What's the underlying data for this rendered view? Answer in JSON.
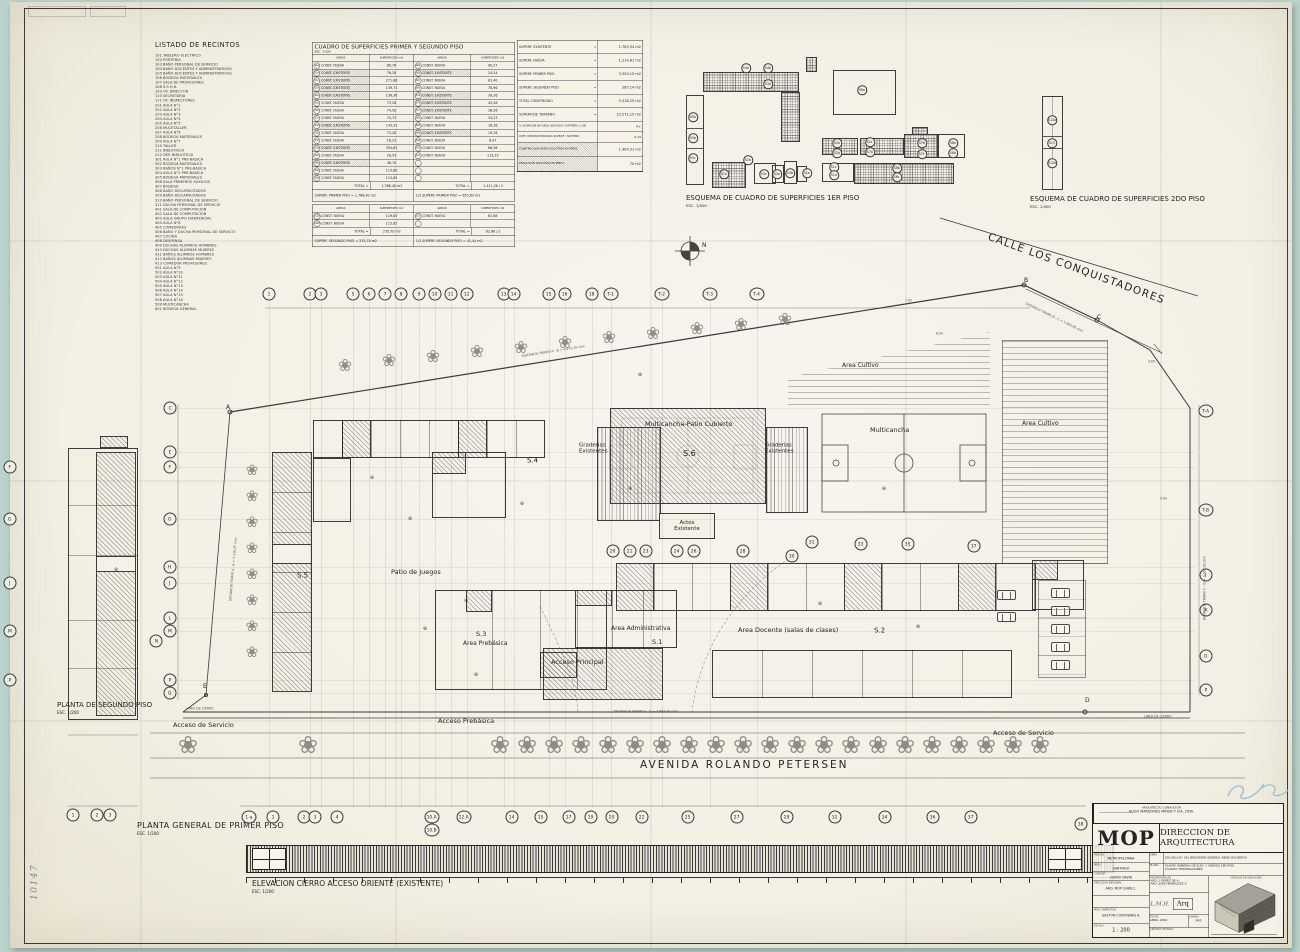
{
  "sheet": {
    "listado_title": "LISTADO DE RECINTOS",
    "planta_general": "PLANTA GENERAL DE PRIMER PISO",
    "planta_general_esc": "ESC. 1/200",
    "planta_segundo": "PLANTA DE SEGUNDO PISO",
    "planta_segundo_esc": "ESC. 1/200",
    "elevacion": "ELEVACION CIERRO ACCESO ORIENTE (EXISTENTE)",
    "elevacion_esc": "ESC. 1/200",
    "esquema1": "ESQUEMA DE CUADRO DE SUPERFICIES 1ER PISO",
    "esquema1_esc": "ESC. 1/500",
    "esquema2": "ESQUEMA DE CUADRO DE SUPERFICIES 2DO PISO",
    "esquema2_esc": "ESC. 1/500",
    "avenida": "AVENIDA ROLANDO PETERSEN",
    "calle": "CALLE LOS CONQUISTADORES",
    "north": "N"
  },
  "annotations": {
    "handwritten_corner": "10147",
    "signature": "L.M.H."
  },
  "listado_items": [
    "101 TABLERO ELECTRICO",
    "102 PORTERIA",
    "103 BAÑO PERSONAL DE SERVICIO",
    "104 BAÑO DOCENTES Y ADMINISTRATIVOS",
    "105 BAÑO DOCENTES Y ADMINISTRATIVOS",
    "106 BODEGA MATERIALES",
    "107 SALA DE PROFESORES",
    "108 S.S.H.H.",
    "109 OF. DIRECTOR",
    "110 SECRETARIA",
    "111 OF. INSPECTORES",
    "201 AULA N°1",
    "202 AULA N°2",
    "203 AULA N°3",
    "204 AULA N°4",
    "205 AULA N°5",
    "206 MULTITALLER",
    "207 AULA N°6",
    "208 BODEGA MATERIALES",
    "209 AULA N°7",
    "210 TALLER",
    "211 BIBLIOTECA",
    "212 DEP. BIBLIOTECA",
    "301 AULA N°1 PRE-BASICA",
    "302 BODEGA MATERIALES",
    "303 BAÑOS N°1 PRE-BASICA",
    "304 AULA N°2 PRE-BASICA",
    "305 BODEGA MATERIALES",
    "306 SALA PRIMEROS AUXILIOS",
    "307 BODEGA",
    "308 BAÑO DISCAPACITADOS",
    "309 BAÑO DISCAPACITADOS",
    "310 BAÑO PERSONAL DE SERVICIO",
    "311 DUCHA PERSONAL DE SERVICIO",
    "401 SALA DE COMPUTACION",
    "402 SALA DE COMPUTACION",
    "403 AULA GRUPO DIFERENCIAL",
    "404 AULA N°8",
    "405 COMEDORES",
    "406 BAÑO Y DUCHA PERSONAL DE SERVICIO",
    "407 COCINA",
    "408 DESPENSA",
    "409 DUCHAS ALUMNOS HOMBRES",
    "410 DUCHAS ALUMNAS MUJERES",
    "411 BAÑOS ALUMNOS HOMBRES",
    "412 BAÑOS ALUMNAS MUJERES",
    "413 COMEDOR PROFESORES",
    "501 AULA N°9",
    "502 AULA N°10",
    "503 AULA N°11",
    "504 AULA N°12",
    "505 AULA N°13",
    "506 AULA N°14",
    "507 AULA N°15",
    "508 AULA N°16",
    "509 MULTICANCHA",
    "601 BODEGA GENERAL"
  ],
  "cuadro": {
    "title": "CUADRO DE SUPERFICIES PRIMER Y SEGUNDO PISO",
    "esc": "ESC. 1/100",
    "headers": [
      "AREAS",
      "SUPERFICIES m2",
      "AREAS",
      "SUPERFICIES m2"
    ],
    "rows1": [
      [
        [
          "S1a",
          "CONST. NUEVA",
          "80,78",
          0
        ],
        [
          "S6a",
          "CONST. NUEVA",
          "90,27",
          0
        ]
      ],
      [
        [
          "S1b",
          "CONST. EXISTENTE",
          "76,28",
          1
        ],
        [
          "S6b",
          "CONST. EXISTENTE",
          "24,54",
          1
        ]
      ],
      [
        [
          "S1c",
          "CONST. EXISTENTE",
          "271,66",
          1
        ],
        [
          "S6c",
          "CONST. NUEVA",
          "61,40",
          0
        ]
      ],
      [
        [
          "S1d",
          "CONST. EXISTENTE",
          "139,71",
          1
        ],
        [
          "S6d",
          "CONST. NUEVA",
          "78,96",
          0
        ]
      ],
      [
        [
          "S1e",
          "CONST. EXISTENTE",
          "136,36",
          1
        ],
        [
          "S7a",
          "CONST. EXISTENTE",
          "39,26",
          1
        ]
      ],
      [
        [
          "S2a",
          "CONST. NUEVA",
          "73,28",
          0
        ],
        [
          "S7b",
          "CONST. EXISTENTE",
          "45,26",
          1
        ]
      ],
      [
        [
          "S2b",
          "CONST. NUEVA",
          "74,50",
          0
        ],
        [
          "S7c",
          "CONST. EXISTENTE",
          "36,26",
          1
        ]
      ],
      [
        [
          "S2c",
          "CONST. NUEVA",
          "74,73",
          0
        ],
        [
          "S8a",
          "CONST. NUEVA",
          "34,23",
          0
        ]
      ],
      [
        [
          "S3a",
          "CONST. EXISTENTE",
          "143,31",
          1
        ],
        [
          "S8b",
          "CONST. NUEVA",
          "18,36",
          0
        ]
      ],
      [
        [
          "S3b",
          "CONST. NUEVA",
          "73,20",
          0
        ],
        [
          "S9a",
          "CONST. EXISTENTE",
          "19,26",
          1
        ]
      ],
      [
        [
          "S3c",
          "CONST. NUEVA",
          "16,23",
          0
        ],
        [
          "S9b",
          "CONST. NUEVA",
          "8,97",
          0
        ]
      ],
      [
        [
          "S3d",
          "CONST. EXISTENTE",
          "394,61",
          1
        ],
        [
          "S10",
          "CONST. NUEVA",
          "86,56",
          0
        ]
      ],
      [
        [
          "S4a",
          "CONST. NUEVA",
          "28,54",
          0
        ],
        [
          "S11",
          "CONST. NUEVA",
          "113,33",
          0
        ]
      ],
      [
        [
          "S4b",
          "CONST. EXISTENTE",
          "46,70",
          1
        ],
        [
          "",
          "",
          "",
          0
        ]
      ],
      [
        [
          "S5a",
          "CONST. NUEVA",
          "113,60",
          0
        ],
        [
          "",
          "",
          "",
          0
        ]
      ],
      [
        [
          "S5b",
          "CONST. NUEVA",
          "113,85",
          0
        ],
        [
          "",
          "",
          "",
          0
        ]
      ]
    ],
    "total1_left_label": "TOTAL =",
    "total1_left_val": "1.766,40 m2",
    "total1_right_label": "TOTAL =",
    "total1_right_val": "1.311,26  /  2",
    "band1_left": "SUPERF. PRIMER PISO  =  1.766,40 m2",
    "band1_right": "1/2 SUPERF. PRIMER PISO  =  655,63 m2",
    "rows2": [
      [
        [
          "S12a",
          "CONST. NUEVA",
          "119,85",
          0
        ],
        [
          "S13",
          "CONST. NUEVA",
          "82,88",
          0
        ]
      ],
      [
        [
          "S12b",
          "CONST. NUEVA",
          "115,85",
          0
        ],
        [
          "",
          "",
          "",
          0
        ]
      ]
    ],
    "total2_left_label": "TOTAL =",
    "total2_left_val": "235,70 m2",
    "total2_right_label": "TOTAL =",
    "total2_right_val": "82,88  /  2",
    "band2_left": "SUPERF. SEGUNDO PISO = 235,70 m2",
    "band2_right": "1/2 SUPERF. SEGUNDO PISO = 41,44 m2"
  },
  "resumen": {
    "rows": [
      {
        "l": "SUPERF. EXISTENTE",
        "v": "1.763,34 m2"
      },
      {
        "l": "SUPERF. NUEVA",
        "v": "1.214,81 m2"
      },
      {
        "l": "SUPERF. PRIMER PISO",
        "v": "3.350,15 m2"
      },
      {
        "l": "SUPERF. SEGUNDO PISO",
        "v": "287,14 m2"
      },
      {
        "l": "TOTAL CONSTRUIDO",
        "v": "3.318,29 m2"
      },
      {
        "l": "SUPERFICIE TERRENO",
        "v": "10.271,15 m2"
      }
    ],
    "small_rows": [
      {
        "l": "% OCUPACION DE SUELO (SUP.OCUP. / SUP.TERR.) x 100",
        "v": "P.V."
      },
      {
        "l": "COEF. CONSTRUCTIBILIDAD (SUP.EDIF. / SUP.TERR.)",
        "v": "0,19"
      }
    ],
    "hatch_rows": [
      {
        "l": "CONSTRUCCION NUEVA SOLICITADA EN PERFIL",
        "v": "1.463,31 m2"
      },
      {
        "l": "DEMOLICION SOLICITADA EN PERFIL",
        "v": "70 m2"
      }
    ]
  },
  "esquemas": {
    "bubbles": [
      [
        "S4a",
        746,
        68
      ],
      [
        "S4b",
        768,
        68
      ],
      [
        "S3d",
        768,
        84
      ],
      [
        "S5a",
        693,
        117
      ],
      [
        "S5b",
        693,
        138
      ],
      [
        "S5c",
        693,
        158
      ],
      [
        "S6a",
        862,
        90
      ],
      [
        "S2a",
        837,
        143
      ],
      [
        "S2b",
        837,
        153
      ],
      [
        "S2c",
        870,
        142
      ],
      [
        "S7a",
        870,
        152
      ],
      [
        "S7b",
        922,
        143
      ],
      [
        "S7c",
        922,
        154
      ],
      [
        "S8a",
        953,
        143
      ],
      [
        "S8b",
        953,
        153
      ],
      [
        "S1a",
        724,
        174
      ],
      [
        "S1b",
        748,
        160
      ],
      [
        "S3c",
        764,
        174
      ],
      [
        "S3a",
        777,
        174
      ],
      [
        "S3b",
        790,
        173
      ],
      [
        "S1e",
        807,
        173
      ],
      [
        "S1c",
        834,
        167
      ],
      [
        "S1d",
        834,
        175
      ],
      [
        "S6b",
        897,
        168
      ],
      [
        "S6c",
        897,
        177
      ],
      [
        "S12a",
        1052,
        120
      ],
      [
        "S13",
        1052,
        143
      ],
      [
        "S12b",
        1052,
        163
      ]
    ]
  },
  "plan": {
    "actos": "Actos\nExistente",
    "labels": [
      {
        "t": "Multicancha-Patio Cubierto",
        "x": 645,
        "y": 417,
        "fs": 6.5
      },
      {
        "t": "S.6",
        "x": 683,
        "y": 449,
        "fs": 8
      },
      {
        "t": "Graderias\nExistentes",
        "x": 579,
        "y": 442,
        "fs": 5.5
      },
      {
        "t": "Graderias\nExistentes",
        "x": 765,
        "y": 442,
        "fs": 5.5
      },
      {
        "t": "Multicancha",
        "x": 870,
        "y": 423,
        "fs": 6.5
      },
      {
        "t": "Area Cultivo",
        "x": 842,
        "y": 358,
        "fs": 6
      },
      {
        "t": "Area Cultivo",
        "x": 1022,
        "y": 416,
        "fs": 6
      },
      {
        "t": "S.4",
        "x": 527,
        "y": 454,
        "fs": 7
      },
      {
        "t": "S.5",
        "x": 297,
        "y": 569,
        "fs": 7
      },
      {
        "t": "Patio de Juegos",
        "x": 391,
        "y": 565,
        "fs": 6.5
      },
      {
        "t": "S.3",
        "x": 476,
        "y": 627,
        "fs": 6.5
      },
      {
        "t": "Area Prebásica",
        "x": 463,
        "y": 636,
        "fs": 6
      },
      {
        "t": "Area Administrativa",
        "x": 611,
        "y": 621,
        "fs": 6
      },
      {
        "t": "S.1",
        "x": 652,
        "y": 635,
        "fs": 6.5
      },
      {
        "t": "Acceso Principal",
        "x": 551,
        "y": 655,
        "fs": 6.5
      },
      {
        "t": "Area Docente (salas de clases)",
        "x": 738,
        "y": 623,
        "fs": 6.5
      },
      {
        "t": "S.2",
        "x": 874,
        "y": 624,
        "fs": 7
      },
      {
        "t": "Acceso de Servicio",
        "x": 173,
        "y": 718,
        "fs": 6.5
      },
      {
        "t": "Acceso Prebásica",
        "x": 438,
        "y": 714,
        "fs": 6.5
      },
      {
        "t": "Acceso de Servicio",
        "x": 993,
        "y": 726,
        "fs": 6.5
      }
    ],
    "dims": [
      {
        "t": "DISTANCIA TRAMO A - B = 4.473,10 cms",
        "x": 520,
        "y": 346,
        "r": -9
      },
      {
        "t": "DISTANCIA TRAMO B - C = 1.965,00 cms",
        "x": 1030,
        "y": 294,
        "r": 26
      },
      {
        "t": "DISTANCIA TRAMO E - D = 3.865,00 cms",
        "x": 614,
        "y": 701,
        "r": 0
      },
      {
        "t": "DISTANCIA TRAMO A - E = 3.116,25 cms",
        "x": 220,
        "y": 600,
        "r": -85
      },
      {
        "t": "DISTANCIA TRAMO C - D = 3.063,00 cms",
        "x": 1194,
        "y": 620,
        "r": -90
      },
      {
        "t": "LINEA DE CIERRO",
        "x": 186,
        "y": 698,
        "r": 0
      },
      {
        "t": "LINEA DE CIERRO",
        "x": 1144,
        "y": 706,
        "r": 0
      },
      {
        "t": "7,00",
        "x": 905,
        "y": 290,
        "r": 0
      },
      {
        "t": "8,00",
        "x": 936,
        "y": 323,
        "r": 0
      },
      {
        "t": "9,00",
        "x": 1148,
        "y": 351,
        "r": 0
      },
      {
        "t": "9,00",
        "x": 1160,
        "y": 488,
        "r": 0
      }
    ],
    "points": [
      [
        "A",
        226,
        405
      ],
      [
        "B",
        1024,
        278
      ],
      [
        "C",
        1097,
        315
      ],
      [
        "D",
        1085,
        698
      ],
      [
        "E",
        203,
        684
      ]
    ],
    "bubbles": [
      [
        "1",
        269,
        294
      ],
      [
        "2",
        310,
        294
      ],
      [
        "3",
        321,
        294
      ],
      [
        "5",
        353,
        294
      ],
      [
        "6",
        369,
        294
      ],
      [
        "7",
        385,
        294
      ],
      [
        "8",
        401,
        294
      ],
      [
        "9",
        419,
        294
      ],
      [
        "10",
        435,
        294
      ],
      [
        "11",
        451,
        294
      ],
      [
        "12",
        467,
        294
      ],
      [
        "13",
        504,
        294
      ],
      [
        "14",
        514,
        294
      ],
      [
        "15",
        549,
        294
      ],
      [
        "16",
        565,
        294
      ],
      [
        "18",
        592,
        294
      ],
      [
        "T-1",
        611,
        294
      ],
      [
        "T-2",
        662,
        294
      ],
      [
        "T-3",
        710,
        294
      ],
      [
        "T-4",
        757,
        294
      ],
      [
        "20",
        613,
        551
      ],
      [
        "21",
        630,
        551
      ],
      [
        "23",
        646,
        551
      ],
      [
        "24",
        677,
        551
      ],
      [
        "26",
        694,
        551
      ],
      [
        "28",
        743,
        551
      ],
      [
        "30",
        792,
        556
      ],
      [
        "31",
        812,
        542
      ],
      [
        "33",
        861,
        544
      ],
      [
        "35",
        908,
        544
      ],
      [
        "37",
        974,
        546
      ],
      [
        "1-a",
        249,
        817
      ],
      [
        "1",
        273,
        817
      ],
      [
        "2",
        304,
        817
      ],
      [
        "3",
        315,
        817
      ],
      [
        "4",
        337,
        817
      ],
      [
        "10.A",
        432,
        817
      ],
      [
        "10.B",
        432,
        830
      ],
      [
        "12.A",
        464,
        817
      ],
      [
        "14",
        512,
        817
      ],
      [
        "15",
        541,
        817
      ],
      [
        "17",
        569,
        817
      ],
      [
        "19",
        591,
        817
      ],
      [
        "20",
        612,
        817
      ],
      [
        "22",
        642,
        817
      ],
      [
        "25",
        688,
        817
      ],
      [
        "27",
        737,
        817
      ],
      [
        "29",
        787,
        817
      ],
      [
        "32",
        835,
        817
      ],
      [
        "34",
        885,
        817
      ],
      [
        "36",
        933,
        817
      ],
      [
        "37",
        971,
        817
      ],
      [
        "38",
        1081,
        824
      ],
      [
        "C",
        170,
        408
      ],
      [
        "E",
        170,
        452
      ],
      [
        "F",
        170,
        467
      ],
      [
        "G",
        170,
        519
      ],
      [
        "H",
        170,
        567
      ],
      [
        "J",
        170,
        583
      ],
      [
        "L",
        170,
        618
      ],
      [
        "M",
        170,
        631
      ],
      [
        "N",
        156,
        641
      ],
      [
        "P",
        170,
        680
      ],
      [
        "Q",
        170,
        693
      ],
      [
        "T-A",
        1206,
        411
      ],
      [
        "T-B",
        1206,
        510
      ],
      [
        "I",
        1206,
        575
      ],
      [
        "K",
        1206,
        610
      ],
      [
        "O",
        1206,
        656
      ],
      [
        "P",
        1206,
        690
      ],
      [
        "F",
        10,
        467
      ],
      [
        "G",
        10,
        519
      ],
      [
        "J",
        10,
        583
      ],
      [
        "M",
        10,
        631
      ],
      [
        "P",
        10,
        680
      ],
      [
        "1",
        73,
        815
      ],
      [
        "2",
        97,
        815
      ],
      [
        "3",
        110,
        815
      ]
    ]
  },
  "titleblock": {
    "consultant1": "ARQUITECTO CONSULTOR",
    "consultant2": "HUGO MARDONES MAYER Y CIA. LTDA.",
    "mop": "MOP",
    "dir": "DIRECCION DE ARQUITECTURA",
    "f_region": "REGION",
    "v_region": "METROPOLITANA",
    "f_prov": "PROV.",
    "v_prov": "SANTIAGO",
    "f_comuna": "COMUNA",
    "v_comuna": "CERRO NAVIA",
    "f_dreg": "DIRECCION REGIONAL",
    "v_dreg": "ARQ. MOP CHBN C.",
    "f_obra": "OBRA",
    "v_obra": "ESCUELA N° 361 BRIGADIER GENERAL RENE IZQUIERDO",
    "f_plano": "PLANO",
    "v_plano1": "PLANTA GENERAL DE ELEV. Y ANEXOS 1ER PISO",
    "v_plano2": "CUADRO TERMINACIONES",
    "f_prof": "PROFESIONALES",
    "v_prof1": "ARQ. J. PEREZ DE A.",
    "v_prof2": "ARQ. JOSE HENRIQUEZ V.",
    "stamp": "Arq",
    "f_fecha": "FECHA",
    "v_fecha": "ABRIL 2004",
    "f_lamina": "LAMINA",
    "v_lamina": "A-0",
    "f_croquis": "CROQUIS DE UBICACION",
    "f_insp": "PROF. INSPECTOR",
    "v_insp": "GASTON CONTRERAS A.",
    "f_escala": "ESCALA",
    "v_escala": "1 : 200",
    "f_archivo": "ARCHIVO TECNICO"
  }
}
